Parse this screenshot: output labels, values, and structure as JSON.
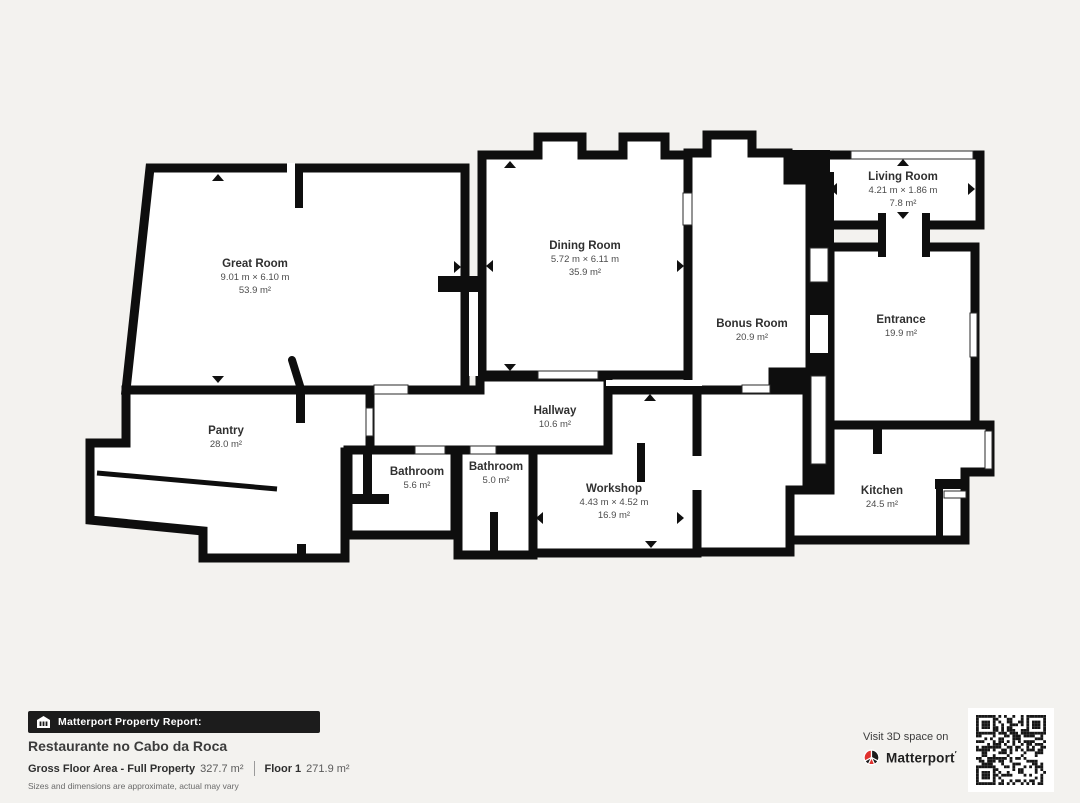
{
  "background_color": "#f3f2ef",
  "wall_color": "#0e0e0e",
  "accent_red": "#e0312e",
  "rooms": [
    {
      "name": "Great Room",
      "dims": "9.01 m × 6.10 m",
      "area": "53.9 m²"
    },
    {
      "name": "Dining Room",
      "dims": "5.72 m × 6.11 m",
      "area": "35.9 m²"
    },
    {
      "name": "Living Room",
      "dims": "4.21 m × 1.86 m",
      "area": "7.8 m²"
    },
    {
      "name": "Bonus Room",
      "area": "20.9 m²"
    },
    {
      "name": "Entrance",
      "area": "19.9 m²"
    },
    {
      "name": "Pantry",
      "area": "28.0 m²"
    },
    {
      "name": "Hallway",
      "area": "10.6 m²"
    },
    {
      "name": "Bathroom",
      "area": "5.6 m²"
    },
    {
      "name": "Bathroom",
      "area": "5.0 m²"
    },
    {
      "name": "Workshop",
      "dims": "4.43 m × 4.52 m",
      "area": "16.9 m²"
    },
    {
      "name": "Kitchen",
      "area": "24.5 m²"
    }
  ],
  "footer": {
    "banner_label": "Matterport Property Report:",
    "property_name": "Restaurante no Cabo da Roca",
    "gross_label": "Gross Floor Area - Full Property",
    "gross_value": "327.7 m²",
    "floor_label": "Floor 1",
    "floor_value": "271.9 m²",
    "disclaimer": "Sizes and dimensions are approximate, actual may vary",
    "visit_text": "Visit 3D space on",
    "brand_name": "Matterport"
  },
  "icons": {
    "banner_icon": "building-icon",
    "brand_icon": "matterport-logo-icon",
    "qr": "qr-code"
  }
}
